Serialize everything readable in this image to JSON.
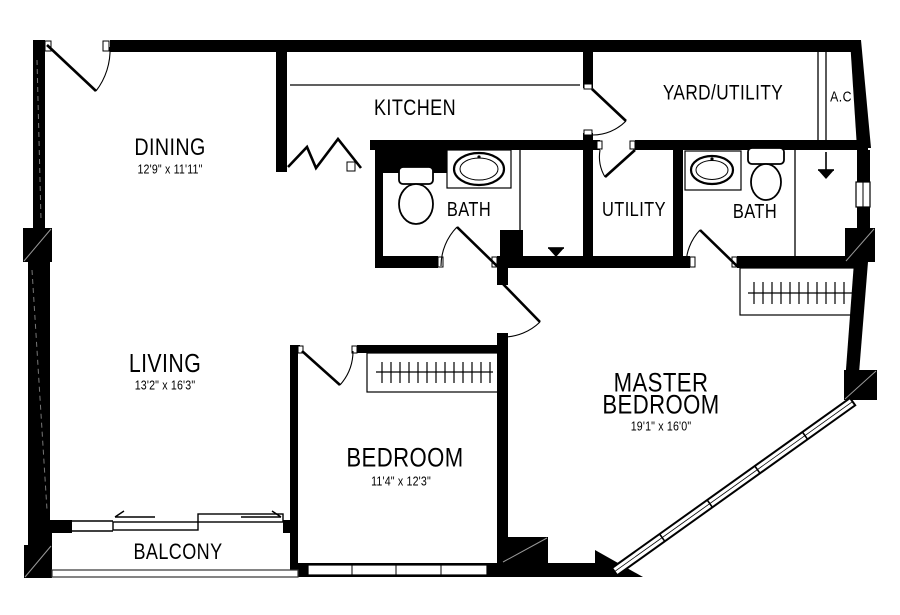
{
  "plan_title": "2 Bedroom Apartment Floor Plan",
  "colors": {
    "wall": "#000000",
    "background": "#ffffff",
    "line": "#000000"
  },
  "rooms": {
    "dining": {
      "label": "DINING",
      "dims": "12'9\" x 11'11\""
    },
    "kitchen": {
      "label": "KITCHEN"
    },
    "bath1": {
      "label": "BATH"
    },
    "utility": {
      "label": "UTILITY"
    },
    "bath2": {
      "label": "BATH"
    },
    "yard_utility": {
      "label": "YARD/UTILITY"
    },
    "ac": {
      "label": "A.C"
    },
    "living": {
      "label": "LIVING",
      "dims": "13'2\" x 16'3\""
    },
    "bedroom": {
      "label": "BEDROOM",
      "dims": "11'4\" x 12'3\""
    },
    "master_bedroom": {
      "line1": "MASTER",
      "line2": "BEDROOM",
      "dims": "19'1\" x 16'0\""
    },
    "balcony": {
      "label": "BALCONY"
    }
  }
}
